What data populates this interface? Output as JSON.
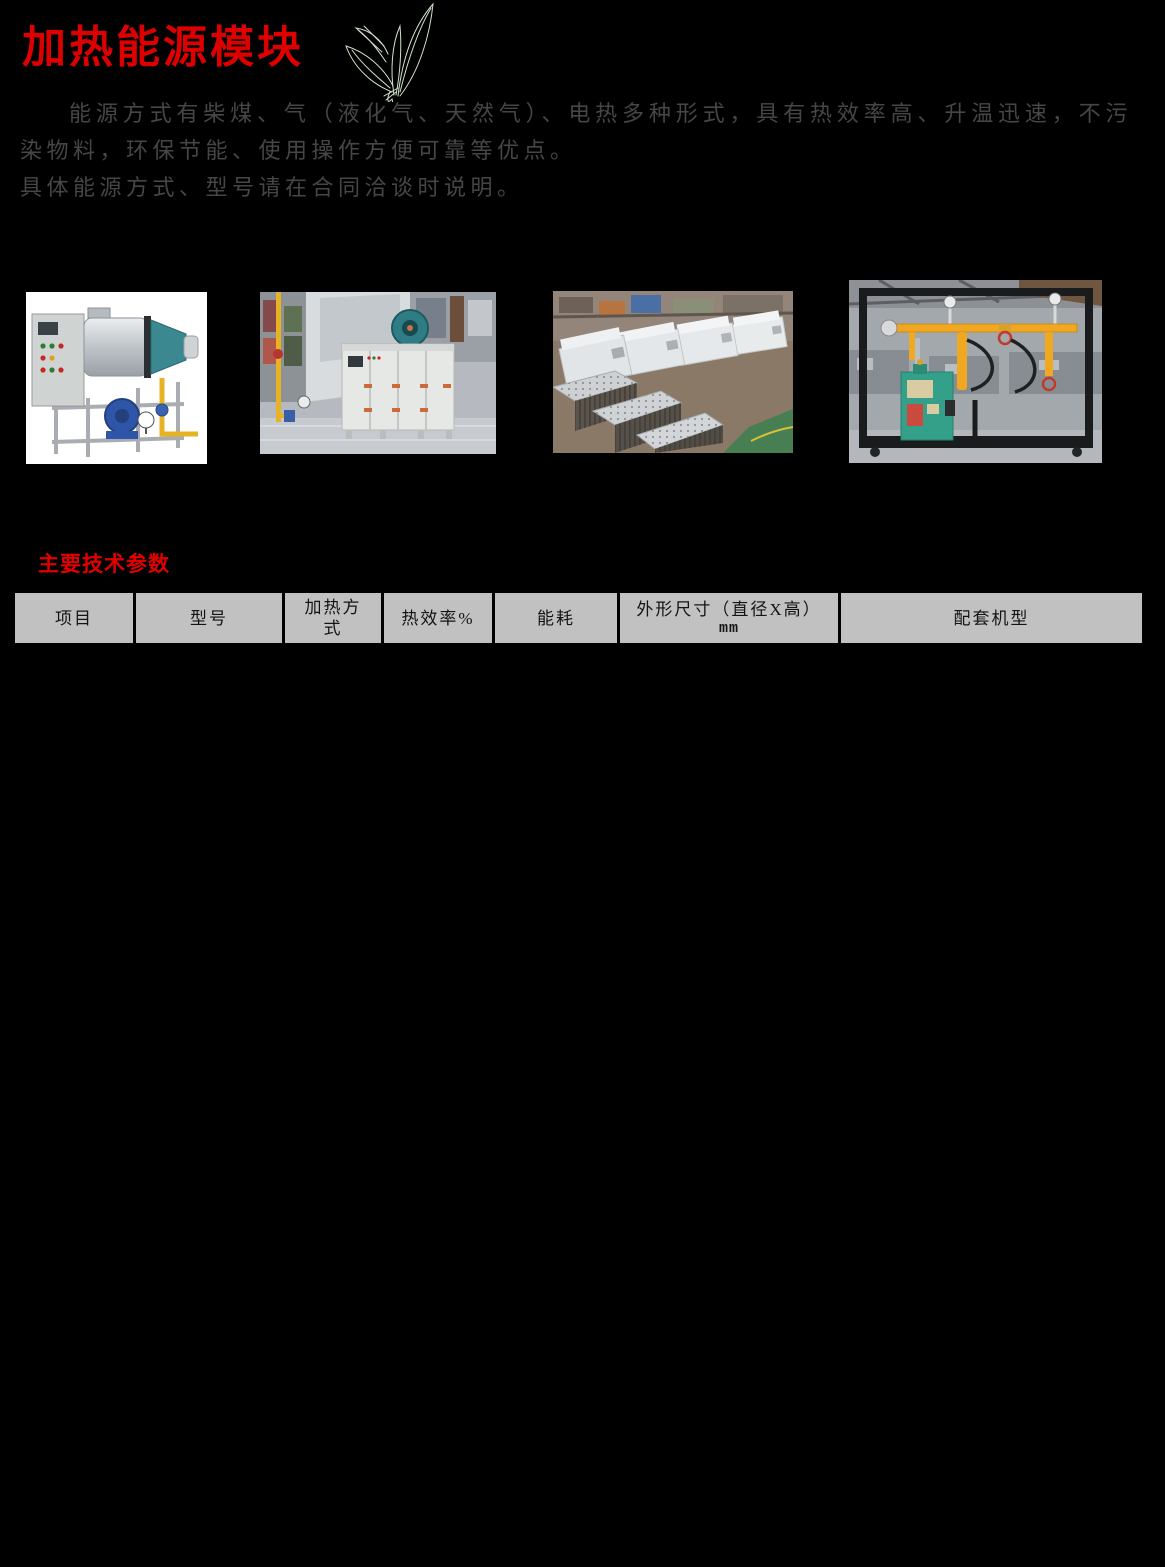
{
  "page": {
    "title": "加热能源模块"
  },
  "intro": {
    "para1": "能源方式有柴煤、气（液化气、天然气）、电热多种形式，具有热效率高、升温迅速，不污染物料，环保节能、使用操作方便可靠等优点。",
    "para2": "具体能源方式、型号请在合同洽谈时说明。"
  },
  "section": {
    "params_heading": "主要技术参数"
  },
  "table": {
    "headers": [
      {
        "label": "项目"
      },
      {
        "label": "型号"
      },
      {
        "label": "加热方式"
      },
      {
        "label": "热效率%"
      },
      {
        "label": "能耗"
      },
      {
        "label": "外形尺寸（直径X高）",
        "sub": "mm"
      },
      {
        "label": "配套机型"
      }
    ],
    "rows": []
  },
  "icons": {
    "leaf": "tea-leaf-sketch-icon"
  },
  "colors": {
    "page_bg": "#000000",
    "accent_red": "#dc0000",
    "body_text": "#464646",
    "table_header_bg": "#c1c1c1",
    "table_header_text": "#141414"
  }
}
